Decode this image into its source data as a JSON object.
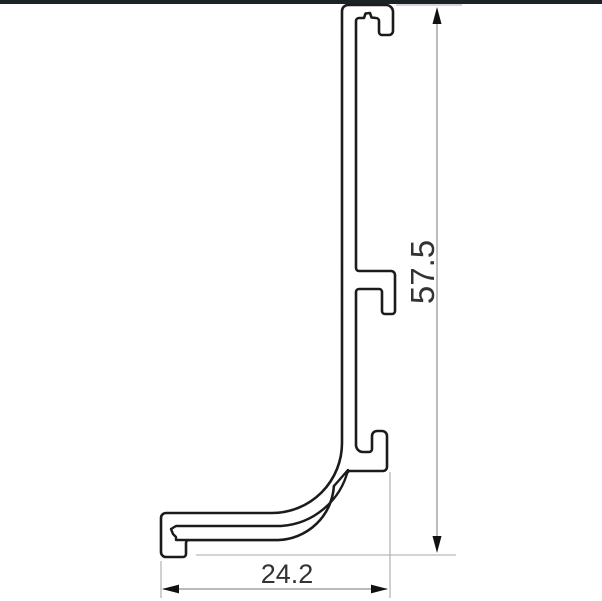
{
  "page": {
    "background": "#ffffff",
    "top_bar_color": "#1c2326"
  },
  "drawing": {
    "type": "technical-cross-section",
    "subject": "extruded-profile-outline",
    "outline_color": "#1b1b1b",
    "extension_line_color": "#a9a9a9",
    "dim_line_color": "#8f8f8f",
    "arrow_color": "#111111",
    "text_color": "#333333",
    "dimensions": {
      "height": {
        "value": "57.5",
        "orientation": "vertical"
      },
      "width": {
        "value": "24.2",
        "orientation": "horizontal"
      }
    }
  }
}
